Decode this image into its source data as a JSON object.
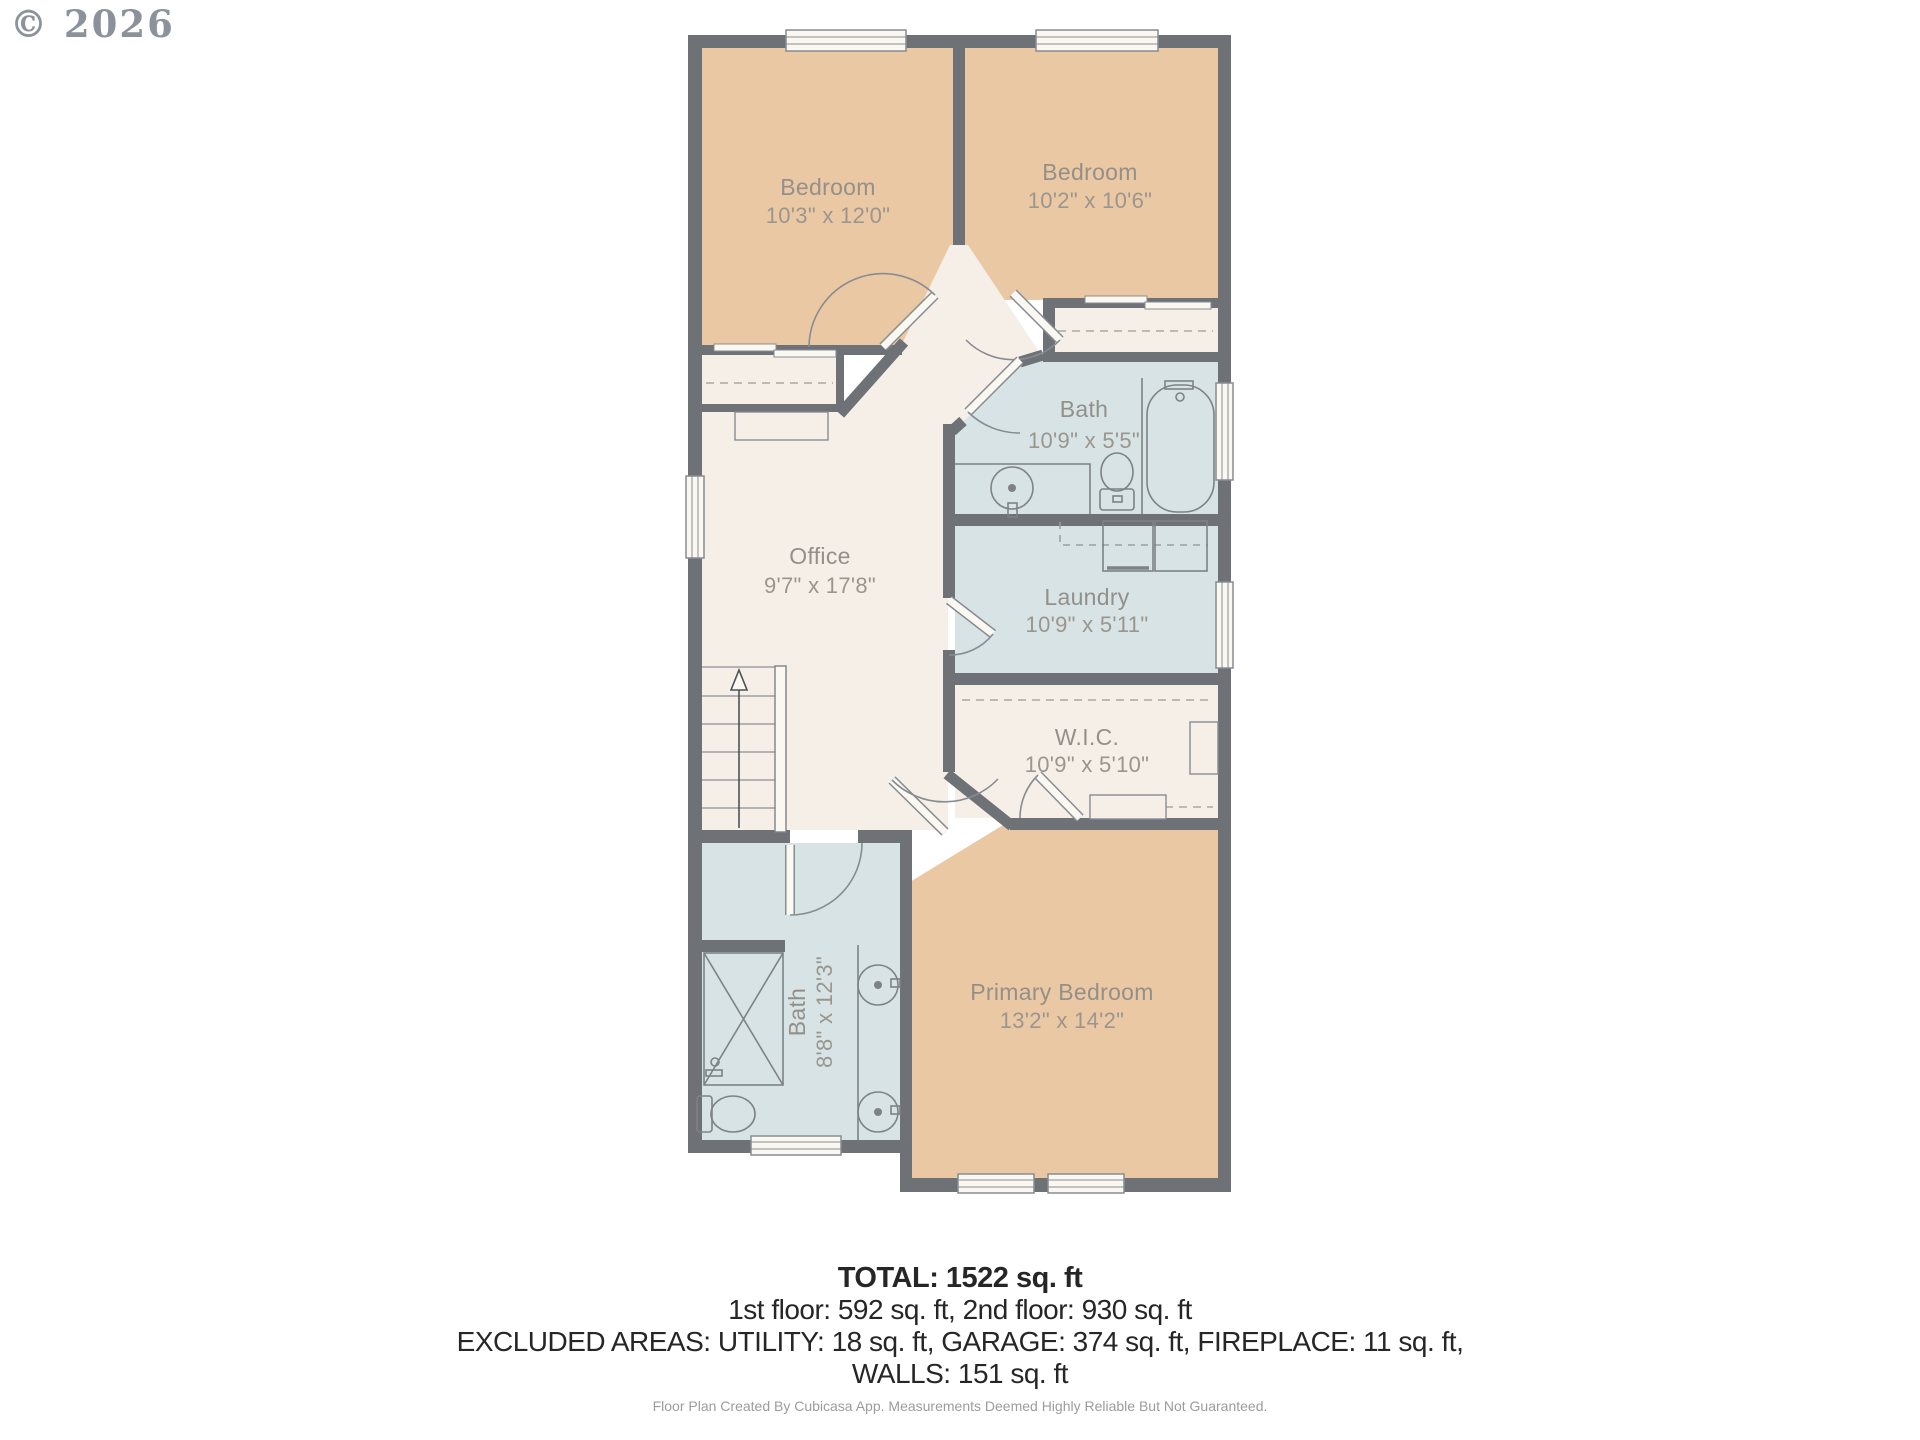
{
  "copyright": "© 2026",
  "floorplan": {
    "rooms": {
      "bedroom1": {
        "name": "Bedroom",
        "dims": "10'3\" x 12'0\""
      },
      "bedroom2": {
        "name": "Bedroom",
        "dims": "10'2\" x 10'6\""
      },
      "bath1": {
        "name": "Bath",
        "dims": "10'9\" x 5'5\""
      },
      "office": {
        "name": "Office",
        "dims": "9'7\" x 17'8\""
      },
      "laundry": {
        "name": "Laundry",
        "dims": "10'9\" x 5'11\""
      },
      "wic": {
        "name": "W.I.C.",
        "dims": "10'9\" x 5'10\""
      },
      "bath2": {
        "name": "Bath",
        "dims": "8'8\" x 12'3\""
      },
      "primary": {
        "name": "Primary Bedroom",
        "dims": "13'2\" x 14'2\""
      }
    },
    "colors": {
      "wall": "#6E7277",
      "bedroom_fill": "#EBC8A4",
      "bath_fill": "#D7E3E4",
      "hall_fill": "#F5EFE7",
      "window_fill": "#FBF8F1"
    }
  },
  "summary": {
    "total": "TOTAL: 1522 sq. ft",
    "floors": "1st floor: 592 sq. ft, 2nd floor: 930 sq. ft",
    "excluded": "EXCLUDED AREAS: UTILITY: 18 sq. ft, GARAGE: 374 sq. ft, FIREPLACE: 11 sq. ft,",
    "walls": "WALLS: 151 sq. ft",
    "disclaimer": "Floor Plan Created By Cubicasa App. Measurements Deemed Highly Reliable But Not Guaranteed."
  }
}
